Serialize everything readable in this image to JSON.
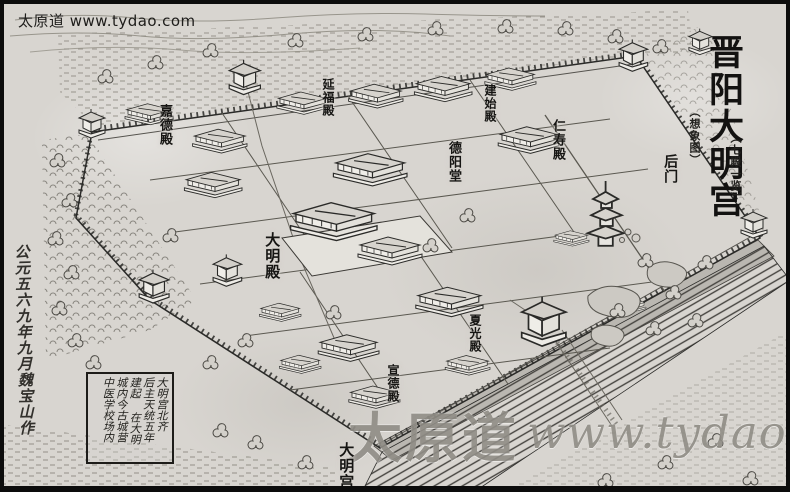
{
  "header": {
    "watermark_small": "太原道 www.tydao.com"
  },
  "title_block": {
    "main": "晋阳大明宫",
    "note_left": "（想象图）",
    "note_right": "（七殿一览）"
  },
  "map_labels": {
    "back_gate": "后门",
    "jiade_hall": "嘉德殿",
    "yanfu_hall": "延福殿",
    "jianshi_hall": "建始殿",
    "deyang_hall": "德阳堂",
    "renshou_hall": "仁寿殿",
    "daming_hall": "大明殿",
    "xiaguang_hall": "夏光殿",
    "xuande_hall": "宣德殿",
    "daming_palace": "大明宫"
  },
  "caption_box": {
    "columns": [
      "大明宫北齐",
      "后主天统五年",
      "建起 在大明",
      "城内今古城营",
      "中医学校场内"
    ]
  },
  "margin_note": "公元五六九年九月魏宝山作",
  "watermark_large": {
    "site_name": "太原道",
    "site_url": "www.tydao.com"
  },
  "colors": {
    "paper": "#d8d5d0",
    "ink": "#2a2a28",
    "watermark": "#908d86"
  }
}
